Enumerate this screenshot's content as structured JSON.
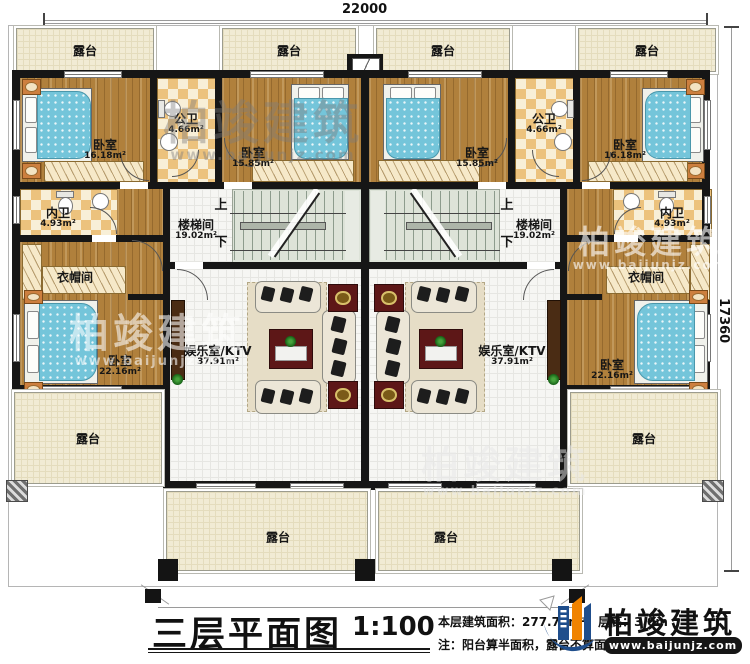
{
  "plan": {
    "dim_top": "22000",
    "dim_right": "17360",
    "terrace": "露台",
    "up": "上",
    "down": "下",
    "rooms": {
      "bedroom": "卧室",
      "bedroom_area_1618": "16.18m²",
      "bedroom_area_1585": "15.85m²",
      "bedroom_area_2216": "22.16m²",
      "public_bath": "公卫",
      "public_bath_area": "4.66m²",
      "private_bath": "内卫",
      "private_bath_area": "4.93m²",
      "cloakroom": "衣帽间",
      "stairwell": "楼梯间",
      "stairwell_area": "19.02m²",
      "ktv": "娱乐室/KTV",
      "ktv_area": "37.91m²"
    }
  },
  "watermark": {
    "brand": "柏竣建筑",
    "url": "www.baijunjz.com"
  },
  "title_block": {
    "title": "三层平面图",
    "scale": "1:100",
    "note1": "本层建筑面积：277.72m²　层高：3.0m",
    "note2": "注：阳台算半面积，露台不算面积",
    "brand": "柏竣建筑",
    "url": "www.baijunjz.com"
  },
  "colors": {
    "wall": "#161616",
    "wood": "#b0803c",
    "terrace": "#f1ebd4",
    "bed": "#74c5da",
    "tv_panel": "#5d1717",
    "brand_blue": "#1f4e8c",
    "brand_orange": "#f08300"
  }
}
